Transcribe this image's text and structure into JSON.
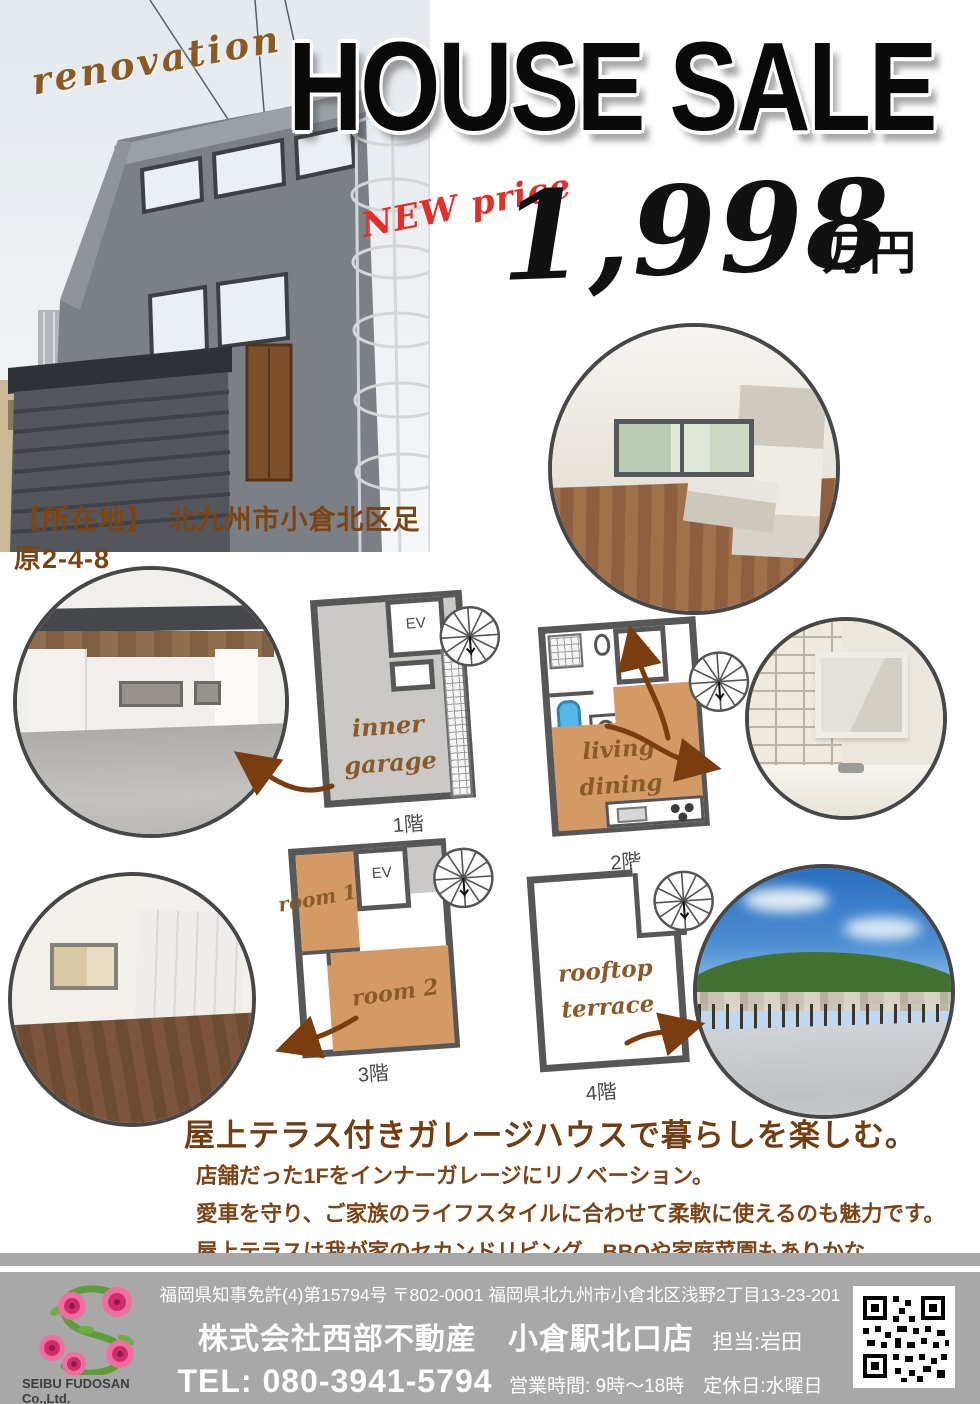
{
  "header": {
    "renovation_label": "renovation",
    "title": "HOUSE SALE",
    "new_price_label": "NEW price",
    "price_number": "1,998",
    "price_unit": "万円",
    "location_line": "【所在地】　北九州市小倉北区足原2-4-8"
  },
  "floor_plans": {
    "floor1": {
      "label": "1階",
      "ev": "EV",
      "room": "inner\ngarage"
    },
    "floor2": {
      "label": "2階",
      "ev": "EV",
      "room": "living\ndining"
    },
    "floor3": {
      "label": "3階",
      "ev": "EV",
      "room1": "room 1",
      "room2": "room 2"
    },
    "floor4": {
      "label": "4階",
      "room": "rooftop\nterrace"
    }
  },
  "body": {
    "headline": "屋上テラス付きガレージハウスで暮らしを楽しむ。",
    "lines": [
      "店舗だった1Fをインナーガレージにリノベーション。",
      "愛車を守り、ご家族のライフスタイルに合わせて柔軟に使えるのも魅力です。",
      "屋上テラスは我が家のセカンドリビング。BBQや家庭菜園もありかな。",
      "使い方を考えるだけでワクワクがとまらない。"
    ]
  },
  "footer": {
    "license_line": "福岡県知事免許(4)第15794号 〒802-0001 福岡県北九州市小倉北区浅野2丁目13-23-201",
    "company": "株式会社西部不動産　小倉駅北口店",
    "agent": "担当:岩田",
    "tel": "TEL: 080-3941-5794",
    "hours": "営業時間: 9時〜18時　定休日:水曜日",
    "logo_text": "SEIBU FUDOSAN Co.,Ltd."
  },
  "colors": {
    "accent_brown": "#7a4518",
    "price_red": "#e42f28",
    "plan_tan": "#d49a66",
    "plan_gray": "#cbc9c6",
    "plan_wall": "#575757",
    "footer_gray": "#a8a8a8"
  }
}
